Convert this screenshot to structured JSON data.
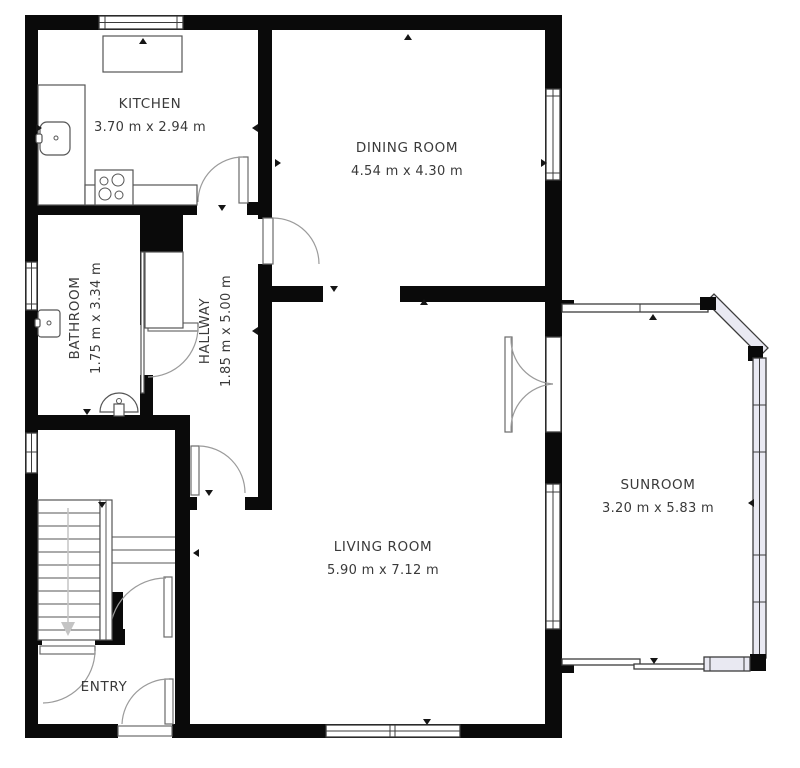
{
  "plan": {
    "rooms": [
      {
        "id": "kitchen",
        "name": "KITCHEN",
        "dims": "3.70 m x 2.94 m"
      },
      {
        "id": "dining-room",
        "name": "DINING ROOM",
        "dims": "4.54 m x 4.30 m"
      },
      {
        "id": "bathroom",
        "name": "BATHROOM",
        "dims": "1.75 m x 3.34 m"
      },
      {
        "id": "hallway",
        "name": "HALLWAY",
        "dims": "1.85 m x 5.00 m"
      },
      {
        "id": "living-room",
        "name": "LIVING ROOM",
        "dims": "5.90 m x 7.12 m"
      },
      {
        "id": "sunroom",
        "name": "SUNROOM",
        "dims": "3.20 m x 5.83 m"
      },
      {
        "id": "entry",
        "name": "ENTRY",
        "dims": ""
      }
    ],
    "colors": {
      "wall": "#0a0a0a",
      "floor": "#ffffff",
      "glazing": "#e9e9f2",
      "line": "#3c3c3c",
      "arc": "#9b9b9b",
      "fixture": "#555555",
      "text": "#3a3a3a",
      "stairarrow": "#c4c4c4"
    }
  }
}
